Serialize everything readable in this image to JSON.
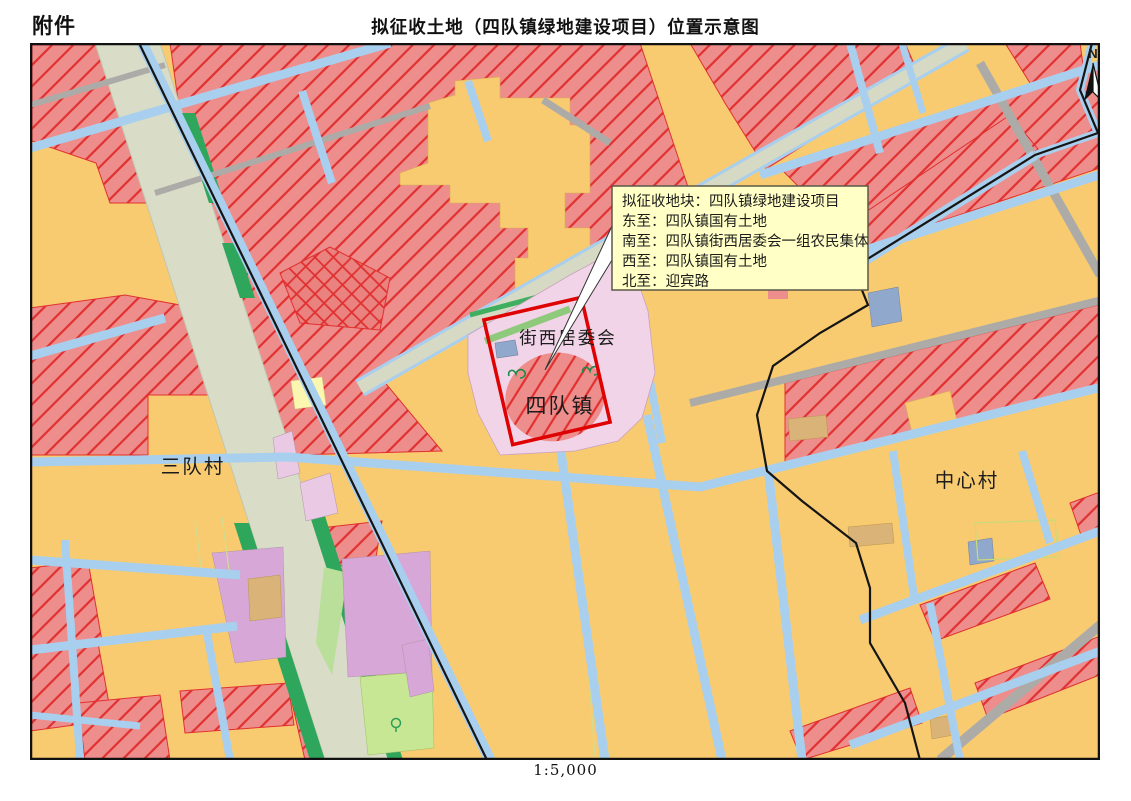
{
  "header": {
    "attachment_label": "附件",
    "title": "拟征收土地（四队镇绿地建设项目）位置示意图"
  },
  "map": {
    "north_label": "N",
    "callout": {
      "lines": [
        "拟征收地块：四队镇绿地建设项目",
        "东至：四队镇国有土地",
        "南至：四队镇街西居委会一组农民集体",
        "西至：四队镇国有土地",
        "北至：迎宾路"
      ]
    },
    "labels": {
      "jiexi_committee": "街西居委会",
      "sidui_town": "四队镇",
      "sandui_village": "三队村",
      "zhongxin_village": "中心村"
    }
  },
  "footer": {
    "scale": "1:5,000"
  },
  "colors": {
    "project_boundary": "#de0202",
    "acquired_parcel_fill": "#ee8e8c",
    "hatch_line": "#e03030",
    "road_fill": "#a9cfef",
    "highway_fill": "#d9dcc6",
    "callout_background": "#ffffc6"
  }
}
